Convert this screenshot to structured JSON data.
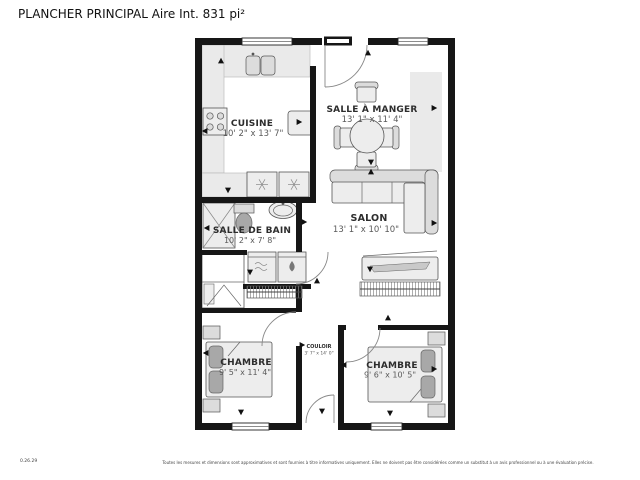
{
  "header": {
    "title": "PLANCHER PRINCIPAL Aire Int. 831 pi²"
  },
  "plan": {
    "rooms": [
      {
        "name": "CUISINE",
        "dims": "10' 2\" x 13' 7\""
      },
      {
        "name": "SALLE À MANGER",
        "dims": "13' 1\" x 11' 4\""
      },
      {
        "name": "SALON",
        "dims": "13' 1\" x 10' 10\""
      },
      {
        "name": "SALLE DE BAIN",
        "dims": "10' 2\" x 7' 8\""
      },
      {
        "name": "COULOIR",
        "dims": "3' 7\" x 14' 0\""
      },
      {
        "name": "CHAMBRE",
        "dims": "9' 5\" x 11' 4\""
      },
      {
        "name": "CHAMBRE",
        "dims": "9' 6\" x 10' 5\""
      }
    ],
    "camera_markers": [
      {
        "x": 221,
        "y": 61,
        "dir": "up"
      },
      {
        "x": 205,
        "y": 131,
        "dir": "left"
      },
      {
        "x": 299,
        "y": 122,
        "dir": "right"
      },
      {
        "x": 228,
        "y": 190,
        "dir": "down"
      },
      {
        "x": 368,
        "y": 53,
        "dir": "up"
      },
      {
        "x": 371,
        "y": 162,
        "dir": "down"
      },
      {
        "x": 371,
        "y": 172,
        "dir": "up"
      },
      {
        "x": 434,
        "y": 108,
        "dir": "right"
      },
      {
        "x": 434,
        "y": 223,
        "dir": "right"
      },
      {
        "x": 370,
        "y": 269,
        "dir": "down"
      },
      {
        "x": 207,
        "y": 228,
        "dir": "left"
      },
      {
        "x": 304,
        "y": 222,
        "dir": "right"
      },
      {
        "x": 250,
        "y": 272,
        "dir": "down"
      },
      {
        "x": 317,
        "y": 281,
        "dir": "up"
      },
      {
        "x": 388,
        "y": 318,
        "dir": "up"
      },
      {
        "x": 206,
        "y": 353,
        "dir": "left"
      },
      {
        "x": 241,
        "y": 412,
        "dir": "down"
      },
      {
        "x": 434,
        "y": 369,
        "dir": "right"
      },
      {
        "x": 390,
        "y": 413,
        "dir": "down"
      },
      {
        "x": 322,
        "y": 411,
        "dir": "down"
      },
      {
        "x": 302,
        "y": 345,
        "dir": "right"
      },
      {
        "x": 344,
        "y": 365,
        "dir": "left"
      }
    ]
  },
  "footer": {
    "code": "0.26.29",
    "disclaimer": "Toutes les mesures et dimensions sont approximatives et sont fournies à titre informatives uniquement. Elles ne doivent pas être considérées comme un substitut à un avis professionnel ou à une évaluation précise."
  },
  "colors": {
    "wall": "#161616",
    "counter": "#eaeaea",
    "furniture": "#ededed",
    "pillow": "#a8a8a8",
    "text_primary": "#111111",
    "text_secondary": "#5a5a5a"
  }
}
